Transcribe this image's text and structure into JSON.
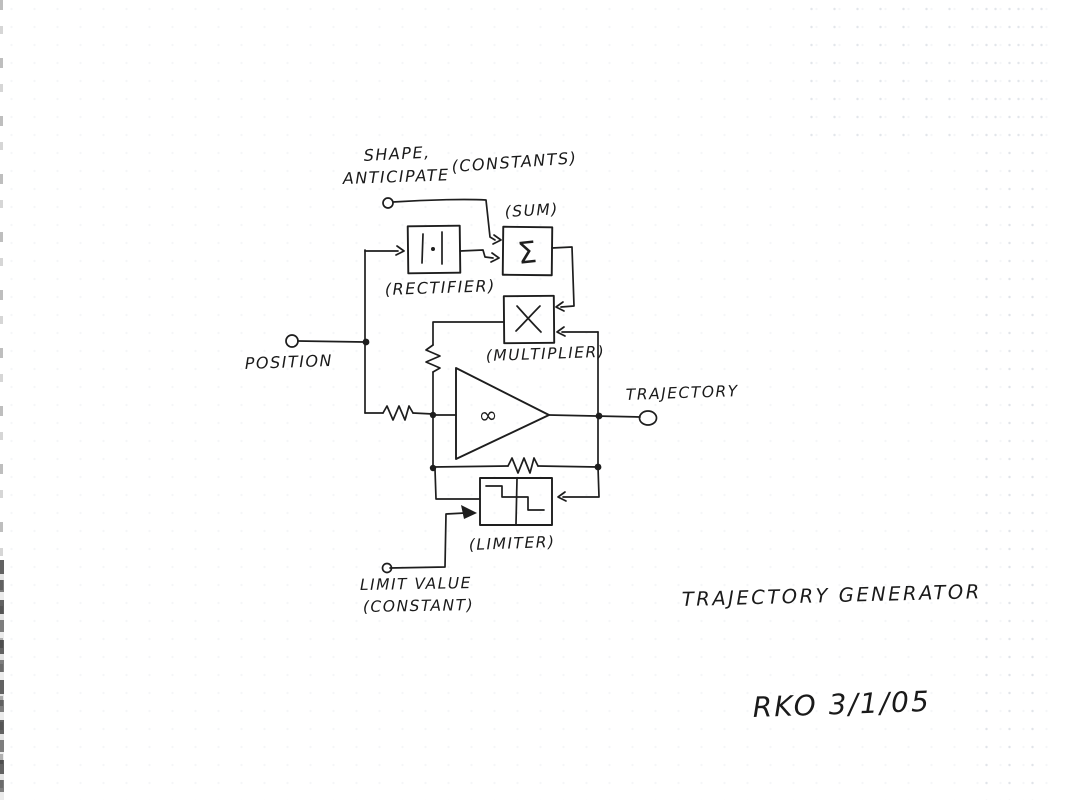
{
  "document": {
    "kind": "hand-drawn analog block diagram (scanned page)",
    "title": "TRAJECTORY GENERATOR",
    "signature": "RKO 3/1/05"
  },
  "labels": {
    "shape_line1": "SHAPE,",
    "shape_line2": "ANTICIPATE",
    "constants_note": "(CONSTANTS)",
    "sum_caption": "(SUM)",
    "rectifier_caption": "(RECTIFIER)",
    "multiplier_caption": "(MULTIPLIER)",
    "position_input": "POSITION",
    "trajectory_output": "TRAJECTORY",
    "limiter_caption": "(LIMITER)",
    "limit_value_line1": "LIMIT VALUE",
    "limit_value_line2": "(CONSTANT)"
  },
  "symbols": {
    "sum_block": "Σ",
    "opamp_gain": "∞",
    "rectifier_block": "|·|",
    "multiplier_block": "X",
    "limiter_block": "saturation-characteristic"
  },
  "colors": {
    "ink": "#1e1e1e",
    "paper": "#ffffff",
    "grid_dot": "#aeb9c6"
  }
}
